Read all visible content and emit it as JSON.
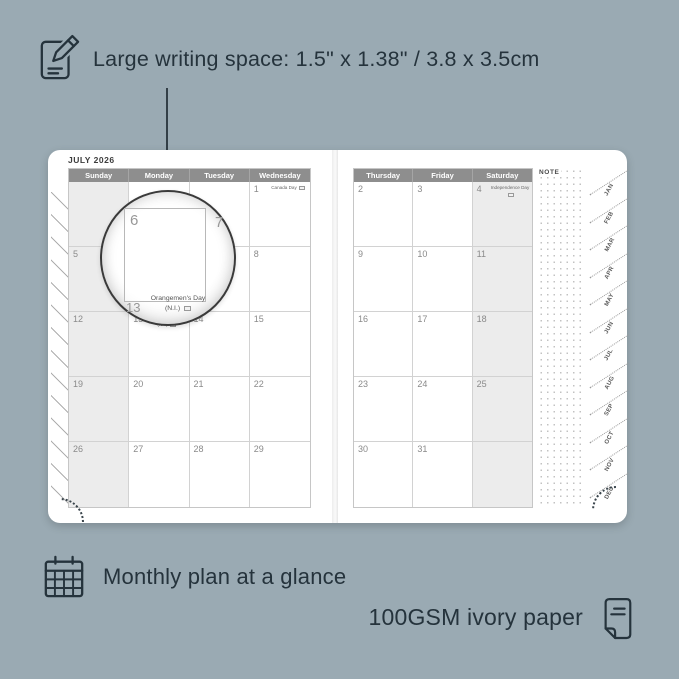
{
  "colors": {
    "background": "#9aaab3",
    "ink": "#25333c",
    "page": "#ffffff",
    "header_bar": "#8e8e8e",
    "header_text": "#ffffff",
    "weekend_shade": "#ececec",
    "grid_line": "#d2d2d2",
    "day_number": "#8a8a8a"
  },
  "features": {
    "writing_space": {
      "icon": "edit-note-icon",
      "text": "Large writing space: 1.5\" x 1.38\" / 3.8 x 3.5cm"
    },
    "monthly_plan": {
      "icon": "calendar-grid-icon",
      "text": "Monthly plan at a glance"
    },
    "paper": {
      "icon": "paper-sheet-icon",
      "text": "100GSM ivory paper"
    }
  },
  "planner": {
    "month_title": "JULY 2026",
    "note_label": "NOTE",
    "left_page": {
      "headers": [
        "Sunday",
        "Monday",
        "Tuesday",
        "Wednesday"
      ],
      "shaded_column": "Sunday",
      "weeks": [
        [
          "",
          "",
          "",
          "1"
        ],
        [
          "5",
          "6",
          "7",
          "8"
        ],
        [
          "12",
          "13",
          "14",
          "15"
        ],
        [
          "19",
          "20",
          "21",
          "22"
        ],
        [
          "26",
          "27",
          "28",
          "29"
        ]
      ],
      "holidays": [
        {
          "day": "1",
          "label": "Canada Day"
        },
        {
          "day": "13",
          "label": "Orangemen's Day (N.I.)"
        }
      ]
    },
    "right_page": {
      "headers": [
        "Thursday",
        "Friday",
        "Saturday"
      ],
      "shaded_column": "Saturday",
      "weeks": [
        [
          "2",
          "3",
          "4"
        ],
        [
          "9",
          "10",
          "11"
        ],
        [
          "16",
          "17",
          "18"
        ],
        [
          "23",
          "24",
          "25"
        ],
        [
          "30",
          "31",
          ""
        ]
      ],
      "holidays": [
        {
          "day": "4",
          "label": "Independence Day"
        }
      ]
    },
    "month_tabs": [
      "JAN",
      "FEB",
      "MAR",
      "APR",
      "MAY",
      "JUN",
      "JUL",
      "AUG",
      "SEP",
      "OCT",
      "NOV",
      "DEC"
    ]
  },
  "magnifier": {
    "zoom_day": "6",
    "adjacent_day": "7",
    "bottom_day": "13",
    "holiday_line1": "Orangemen's Day",
    "holiday_line2": "(N.I.)"
  }
}
